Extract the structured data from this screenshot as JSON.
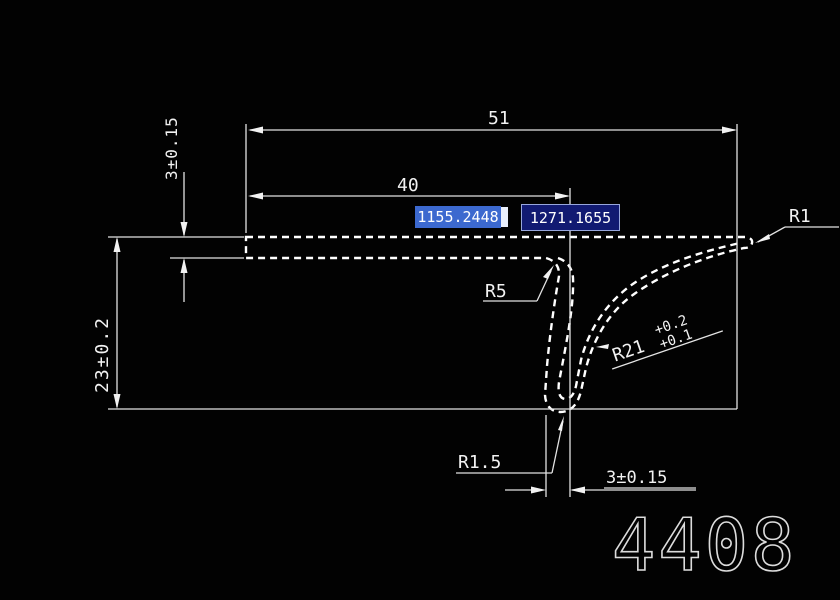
{
  "drawing": {
    "type": "cad-section-profile",
    "background_color": "#020202",
    "line_color": "#f2f2f2",
    "stamp_number": "4408",
    "dimensions": {
      "total_width": "51",
      "hook_offset_width": "40",
      "top_thickness": "3±0.15",
      "overall_height": "23±0.2",
      "hook_gap": "3±0.15"
    },
    "radius_labels": {
      "r5": "R5",
      "r1": "R1",
      "r15": "R1.5",
      "r21": "R21",
      "r21_tol_upper": "+0.2",
      "r21_tol_lower": "+0.1"
    },
    "coord_inputs": {
      "x_value": "1155.2448",
      "y_value": "1271.1655",
      "active_bg": "#3c69cf",
      "inactive_bg": "#111a72"
    }
  }
}
